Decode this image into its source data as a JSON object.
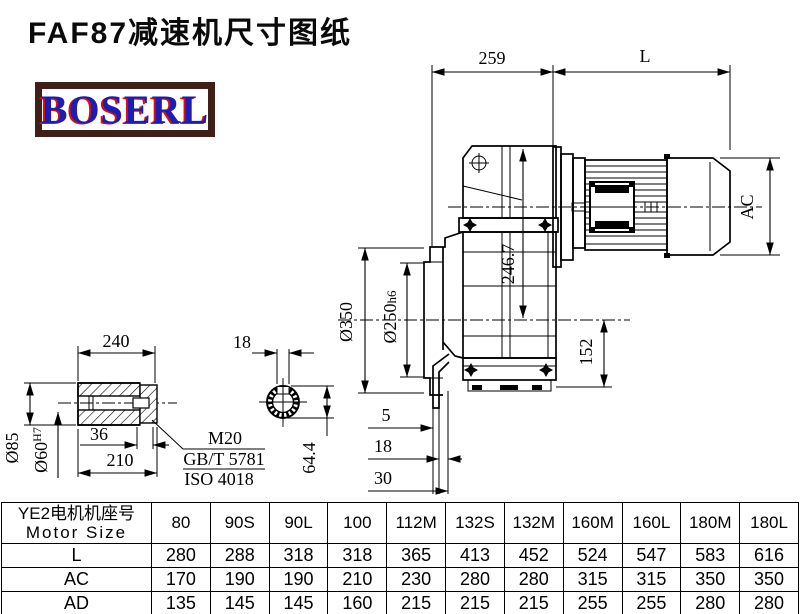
{
  "title": "FAF87减速机尺寸图纸",
  "logo": "BOSERL",
  "dims": {
    "d259": "259",
    "dL": "L",
    "dAC": "AC",
    "d2467": "246.7",
    "d350": "Ø350",
    "d250": "Ø250",
    "d250suf": "h6",
    "d152": "152",
    "d5": "5",
    "d18side": "18",
    "d30": "30",
    "d240": "240",
    "d18key": "18",
    "d85": "Ø85",
    "d60": "Ø60",
    "d60sup": "H7",
    "d36": "36",
    "d210": "210",
    "m20": "M20",
    "gbt": "GB/T 5781",
    "iso": "ISO 4018",
    "d644": "64.4"
  },
  "table": {
    "header_cn": "YE2电机机座号",
    "header_en": "Motor Size",
    "columns": [
      "80",
      "90S",
      "90L",
      "100",
      "112M",
      "132S",
      "132M",
      "160M",
      "160L",
      "180M",
      "180L"
    ],
    "rows": [
      {
        "label": "L",
        "values": [
          "280",
          "288",
          "318",
          "318",
          "365",
          "413",
          "452",
          "524",
          "547",
          "583",
          "616"
        ]
      },
      {
        "label": "AC",
        "values": [
          "170",
          "190",
          "190",
          "210",
          "230",
          "280",
          "280",
          "315",
          "315",
          "350",
          "350"
        ]
      },
      {
        "label": "AD",
        "values": [
          "135",
          "145",
          "145",
          "160",
          "215",
          "215",
          "215",
          "255",
          "255",
          "280",
          "280"
        ]
      }
    ]
  }
}
